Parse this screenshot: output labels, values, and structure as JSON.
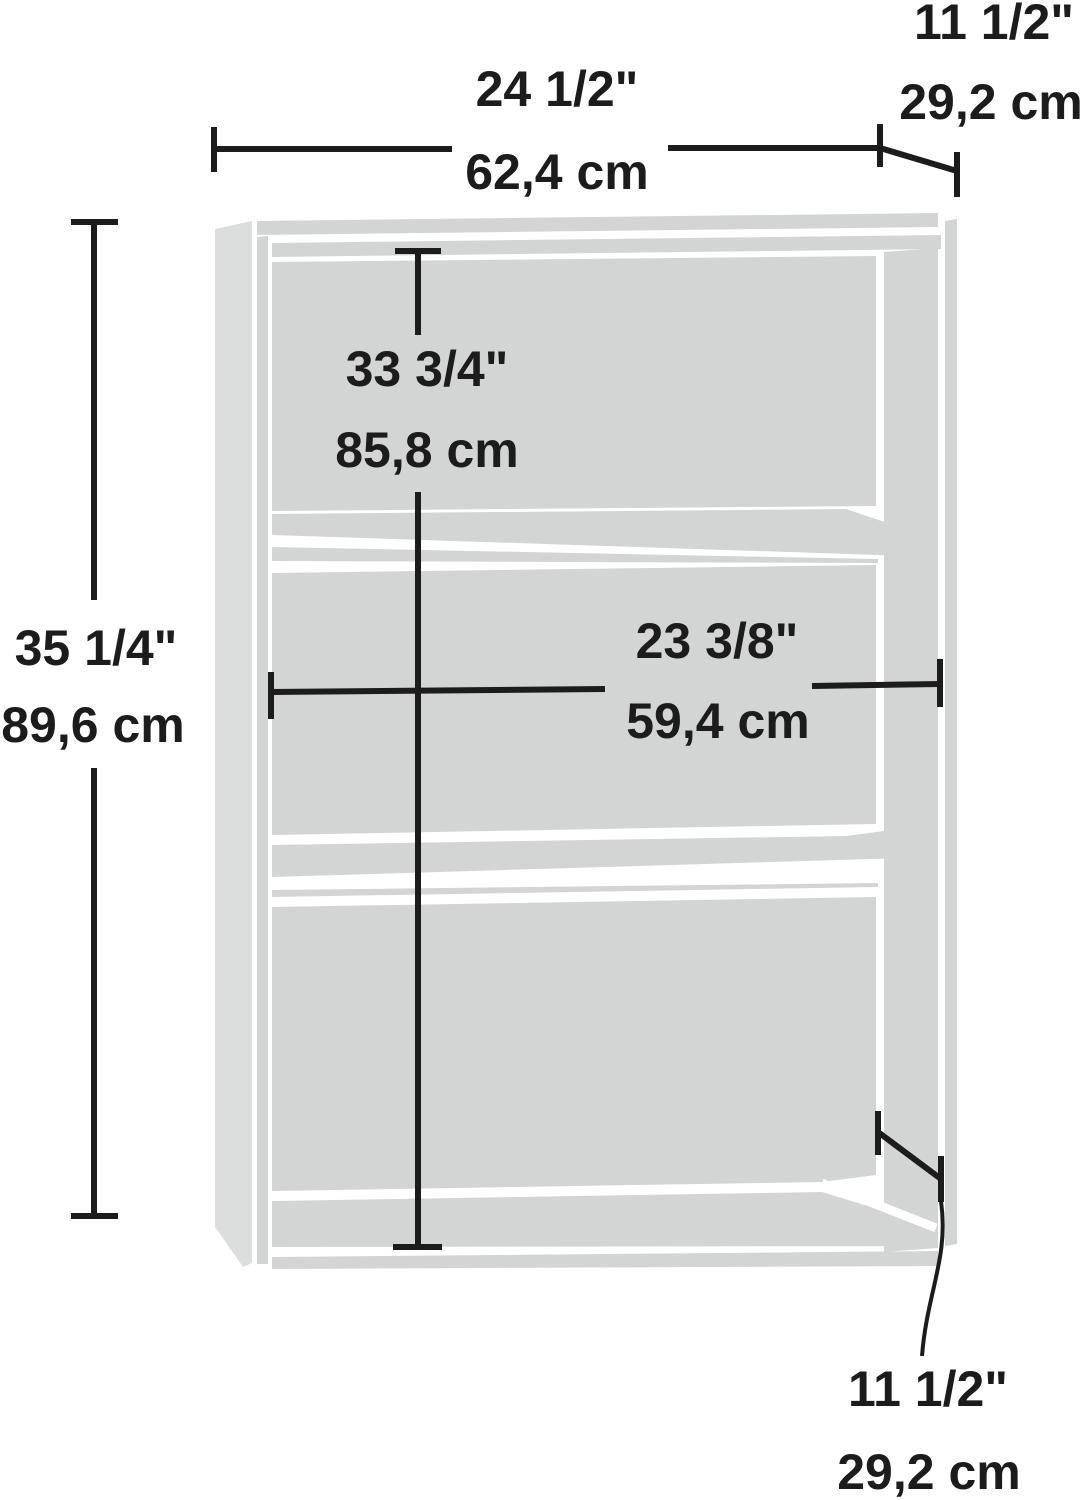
{
  "colors": {
    "background": "#ffffff",
    "line": "#1c1c1c",
    "case_gray": "#d3d5d4",
    "side_panel_gray": "#dcdedd"
  },
  "dimensions": {
    "overall_width": {
      "inches": "24 1/2\"",
      "metric": "62,4 cm"
    },
    "top_depth": {
      "inches": "11 1/2\"",
      "metric": "29,2 cm"
    },
    "overall_height": {
      "inches": "35 1/4\"",
      "metric": "89,6 cm"
    },
    "interior_height": {
      "inches": "33 3/4\"",
      "metric": "85,8 cm"
    },
    "interior_width": {
      "inches": "23 3/8\"",
      "metric": "59,4 cm"
    },
    "bottom_depth": {
      "inches": "11 1/2\"",
      "metric": "29,2 cm"
    }
  }
}
